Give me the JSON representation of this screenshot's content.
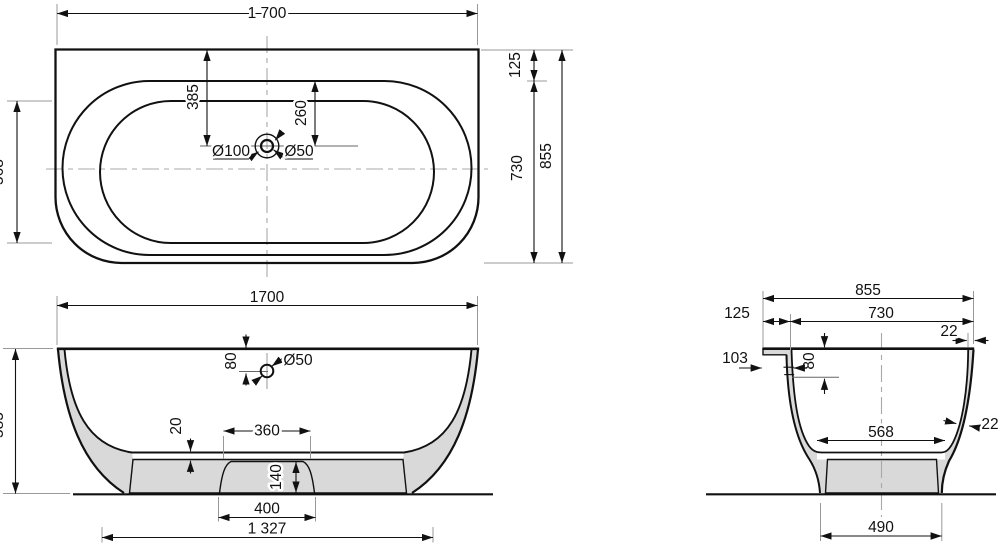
{
  "colors": {
    "line": "#111111",
    "extension": "#999999",
    "wall_fill": "#d9d9d9",
    "background": "#ffffff"
  },
  "views": {
    "top": {
      "dims": {
        "length": "1 700",
        "width": "855",
        "inner_width": "730",
        "rim_offset": "125",
        "basin_width": "568",
        "drain_to_back": "385",
        "drain_to_rim": "260",
        "drain_outer": "Ø100",
        "drain_hole": "Ø50"
      }
    },
    "front": {
      "dims": {
        "length": "1700",
        "height": "585",
        "drain_depth": "80",
        "drain_hole": "Ø50",
        "floor_gap": "20",
        "arch_top": "360",
        "arch_height": "140",
        "arch_bottom": "400",
        "base_span": "1 327"
      }
    },
    "side": {
      "dims": {
        "width": "855",
        "inner_width": "730",
        "rim_offset": "125",
        "wall_top": "22",
        "flange_depth": "103",
        "overflow_depth": "80",
        "basin_width": "568",
        "wall_lower": "22",
        "foot_span": "490"
      }
    }
  }
}
